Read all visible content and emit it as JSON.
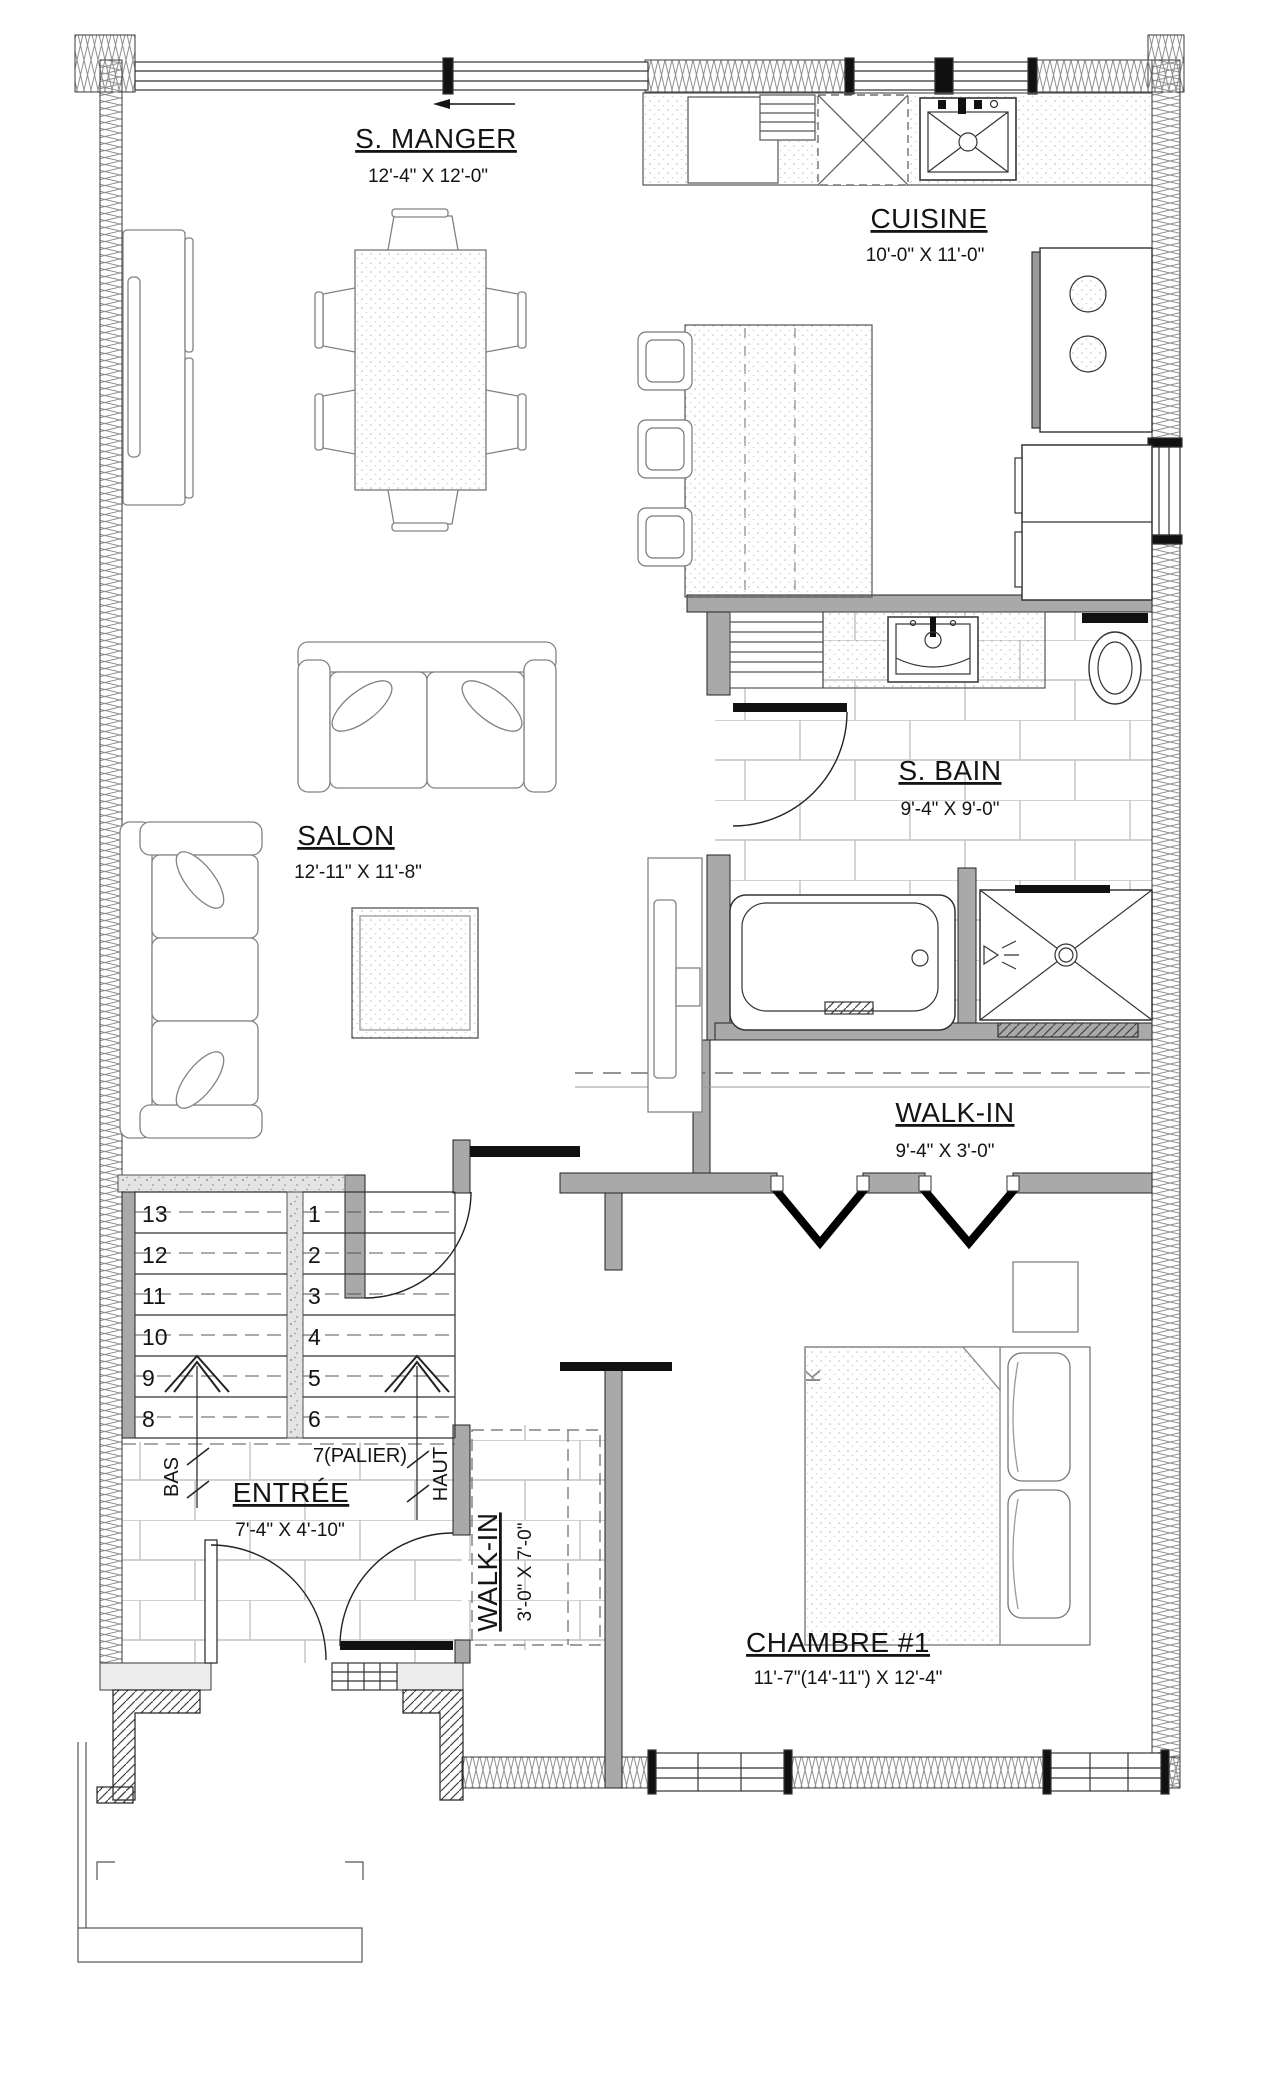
{
  "rooms": {
    "dining": {
      "label": "S. MANGER",
      "dims": "12'-4\" X 12'-0\""
    },
    "kitchen": {
      "label": "CUISINE",
      "dims": "10'-0\" X 11'-0\""
    },
    "living": {
      "label": "SALON",
      "dims": "12'-11\" X 11'-8\""
    },
    "bathroom": {
      "label": "S. BAIN",
      "dims": "9'-4\" X 9'-0\""
    },
    "walkin_main": {
      "label": "WALK-IN",
      "dims": "9'-4\" X 3'-0\""
    },
    "entry": {
      "label": "ENTRÉE",
      "dims": "7'-4\" X 4'-10\""
    },
    "walkin_entry": {
      "label": "WALK-IN",
      "dims": "3'-0\" X 7'-0\""
    },
    "bedroom": {
      "label": "CHAMBRE #1",
      "dims": "11'-7\"(14'-11\") X 12'-4\""
    }
  },
  "stairs": {
    "left_steps": [
      "13",
      "12",
      "11",
      "10",
      "9",
      "8"
    ],
    "right_steps": [
      "1",
      "2",
      "3",
      "4",
      "5",
      "6"
    ],
    "landing": "7(PALIER)",
    "down_label": "BAS",
    "up_label": "HAUT"
  },
  "bed": {
    "size_label": "K"
  },
  "colors": {
    "interior_wall": "#a9a9a9",
    "line": "#141414",
    "tile_line": "#c2c2c2"
  }
}
